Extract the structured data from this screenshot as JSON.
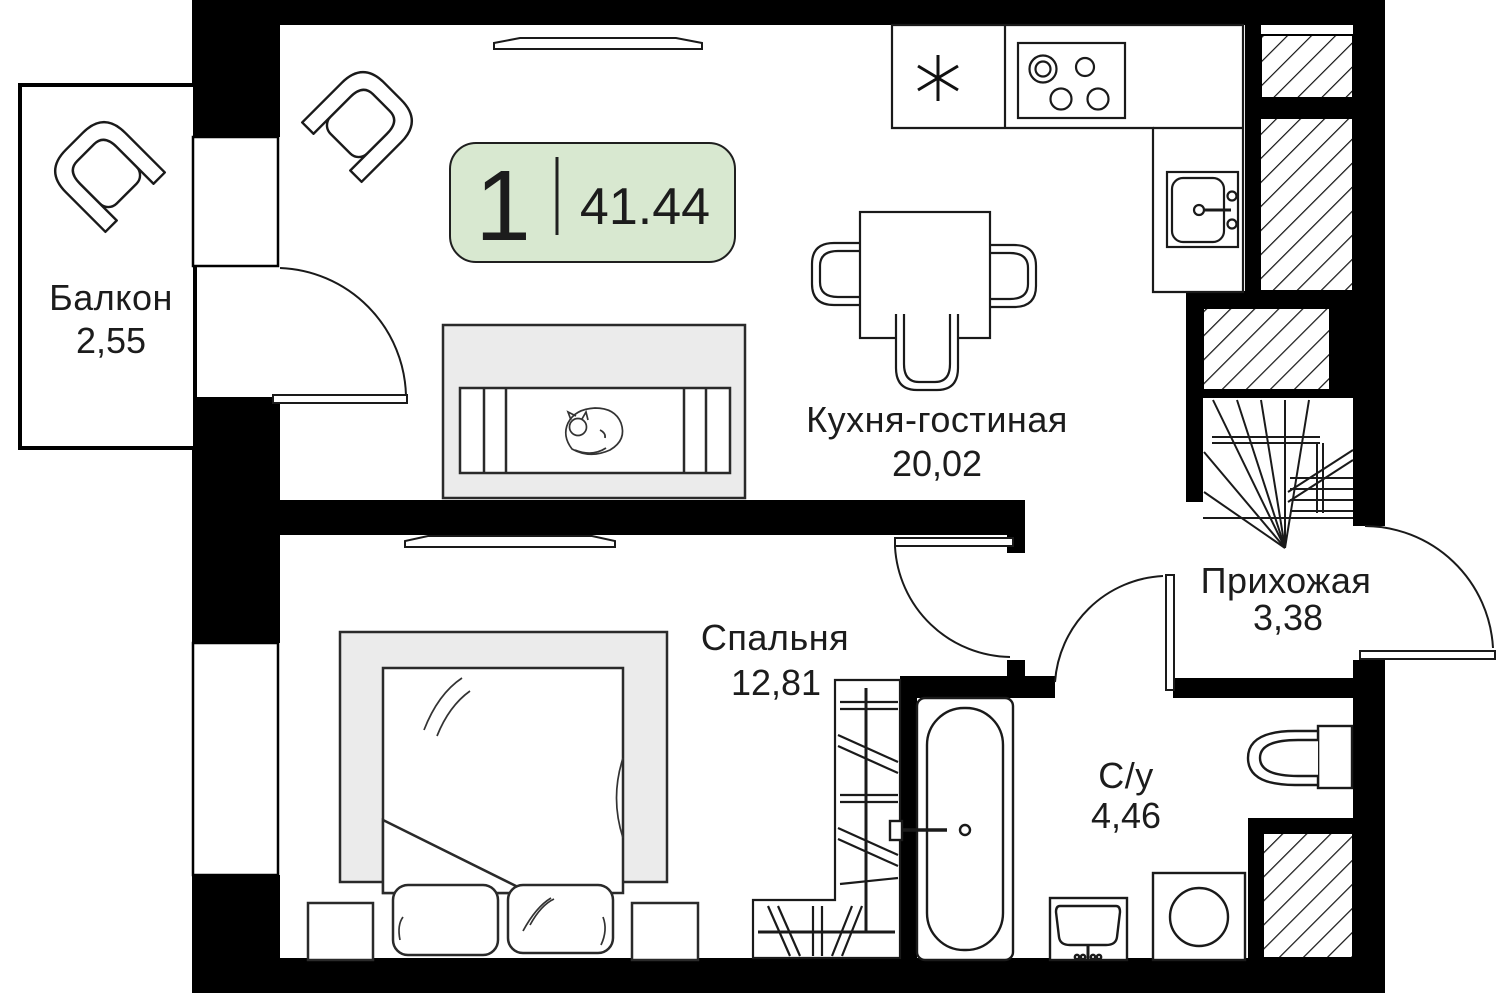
{
  "plan": {
    "type_badge": {
      "rooms_count": "1",
      "area_m2": "41.44"
    },
    "rooms": [
      {
        "name": "Кухня-гостиная",
        "area": "20,02"
      },
      {
        "name": "Спальня",
        "area": "12,81"
      },
      {
        "name": "Прихожая",
        "area": "3,38"
      },
      {
        "name": "С/у",
        "area": "4,46"
      },
      {
        "name": "Балкон",
        "area": "2,55"
      }
    ],
    "colors": {
      "badge_bg": "#d8e8d0",
      "badge_border": "#1f1f1f",
      "wall": "#000000",
      "upholstery_fill": "#ebebeb",
      "line": "#1a1a1a",
      "text": "#1c1c1c"
    },
    "symbols": [
      "fridge-asterisk",
      "cooktop-4-burners",
      "kitchen-sink",
      "dining-table",
      "dining-chair",
      "armchair",
      "sofa",
      "sleeping-cat",
      "tv-panel",
      "double-bed",
      "pillows",
      "nightstand",
      "wardrobe-with-rail",
      "bathtub",
      "washbasin",
      "washing-machine",
      "toilet",
      "staircase",
      "ventilation-shaft",
      "door-swing",
      "window"
    ]
  }
}
